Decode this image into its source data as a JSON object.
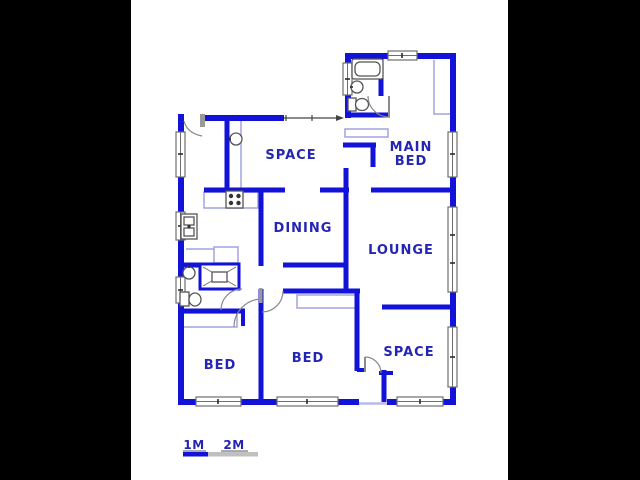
{
  "window_title": "Floor plan",
  "colors": {
    "background": "#000000",
    "plan_background": "#ffffff",
    "wall_blue": "#1212d9",
    "label_blue": "#2525b5",
    "window_gray": "#6e6e6e",
    "furniture_lavender": "#a3a3e0",
    "scale_bar_blue": "#1212d9",
    "scale_bar_gray": "#c0c0c0"
  },
  "rooms": [
    {
      "id": "space-top",
      "label": "SPACE"
    },
    {
      "id": "main-bed",
      "label": "MAIN BED",
      "lines": [
        "MAIN",
        "BED"
      ]
    },
    {
      "id": "dining",
      "label": "DINING"
    },
    {
      "id": "lounge",
      "label": "LOUNGE"
    },
    {
      "id": "bed-1",
      "label": "BED"
    },
    {
      "id": "bed-2",
      "label": "BED"
    },
    {
      "id": "space-bottom",
      "label": "SPACE"
    }
  ],
  "fixtures": [
    "bathtub",
    "basin",
    "toilet",
    "stove",
    "kitchen-sink",
    "shower",
    "basin",
    "toilet"
  ],
  "scale_bar": {
    "label_1m": "1M",
    "label_2m": "2M"
  }
}
